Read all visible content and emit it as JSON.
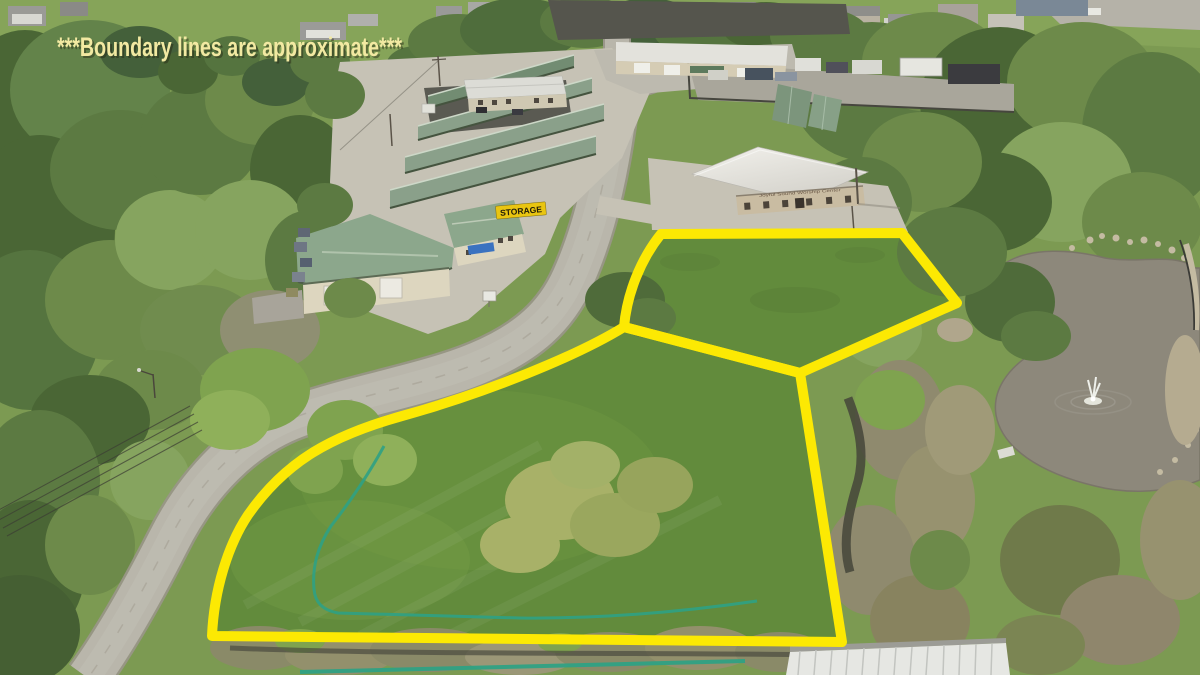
{
  "annotation": {
    "text": "***Boundary lines are approximate***"
  },
  "signs": {
    "storage_sign": "STORAGE",
    "building_sign": "Joyful Sound Worship Center"
  },
  "colors": {
    "boundary_yellow": "#FCE903",
    "annotation_text": "#F2E9A2",
    "silt_fence_teal": "#2FA184",
    "storage_roof_green": "#8AA08A",
    "warehouse_roof_green": "#8CA78C",
    "pond_water": "#8D887B",
    "parcel_grass": "#628B3C",
    "road_pavement": "#B9B6AB",
    "storage_sign_bg": "#E9C511",
    "awning_blue": "#3A72C0"
  }
}
